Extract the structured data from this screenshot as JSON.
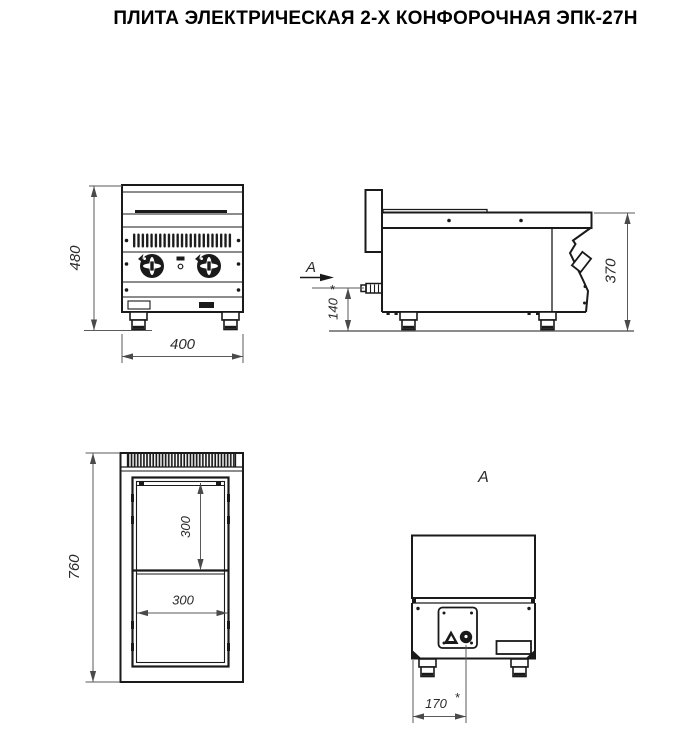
{
  "title": "ПЛИТА ЭЛЕКТРИЧЕСКАЯ 2-Х КОНФОРОЧНАЯ ЭПК-27Н",
  "views": {
    "front": {
      "height_dim": "480",
      "width_dim": "400"
    },
    "side": {
      "arrow_label": "А",
      "height_dim": "370",
      "cord_height_dim": "140",
      "cord_note": "*"
    },
    "plan": {
      "depth_dim": "760",
      "burner_depth_dim": "300",
      "burner_width_dim": "300"
    },
    "rear": {
      "view_title": "А",
      "cord_offset_dim": "170",
      "cord_note": "*"
    }
  },
  "colors": {
    "outline": "#1a1a1a",
    "dimension": "#5a5a5a",
    "background": "#ffffff"
  }
}
